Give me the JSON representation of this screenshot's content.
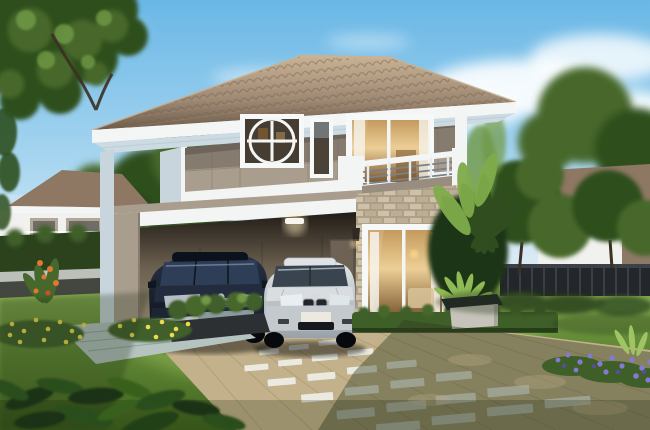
{
  "meta": {
    "title": "Two-story suburban house exterior 3D rendering",
    "time_of_day": "daytime",
    "visible_text": "none"
  },
  "scene": {
    "main_house": {
      "name": "two-story-house",
      "features": [
        "hip tiled roof",
        "two-tone taupe upper facade",
        "circle motif window",
        "slim window",
        "balcony with metal railing",
        "sliding glass balcony door",
        "stone veneer ground wall",
        "large sliding patio door with curtains",
        "two wall sconces",
        "double carport with ceiling light"
      ]
    },
    "vehicles": [
      {
        "name": "dark-sedan",
        "color": "dark navy"
      },
      {
        "name": "silver-sedan",
        "color": "silver"
      }
    ],
    "landscape": [
      "front lawn",
      "paved driveway with white inset pavers",
      "stone slab walkway",
      "planter box with shrubs",
      "yellow flower beds",
      "orange flowers",
      "purple flower border",
      "tropical plants and fan palm",
      "concrete garden bench",
      "low trimmed hedges",
      "overhanging tree canopy top-left",
      "foreground dark foliage"
    ],
    "surroundings": [
      "neighbor house left",
      "neighbor house right",
      "perimeter hedge wall with concrete cap",
      "dark metal fence",
      "background trees",
      "blue sky with clouds"
    ]
  },
  "colors": {
    "sky_top": "#69b7e6",
    "sky_mid": "#a9d6f0",
    "sky_low": "#e9f4fb",
    "cloud": "#ffffff",
    "haze": "#dfe9ee",
    "roof_hi": "#c9b294",
    "roof_md": "#9d8873",
    "roof_lo": "#6f5d4b",
    "fascia": "#f4f6f6",
    "soffit": "#ccdae2",
    "taupe_dk": "#867b6f",
    "taupe_lt": "#a99d8e",
    "band": "#f2f5f4",
    "side": "#c8d5dc",
    "frame": "#f7f9f9",
    "glass_dk": "#453c32",
    "warm_hi": "#eccf96",
    "warm_md": "#c49a5e",
    "warm_lo": "#7d5a32",
    "curtain": "#f6f2ea",
    "rail": "#798089",
    "panel": "#998d80",
    "stone": "#cdc1a9",
    "stone2": "#bcae95",
    "stoneln": "#a3947b",
    "cp_dark": "#211c16",
    "cp_mid": "#6e6252",
    "cp_wall": "#94876f",
    "cp_floor": "#c9b78d",
    "door_in": "#6e6254",
    "car1": "#161f2d",
    "car1w": "#31405a",
    "chrome": "#a9b1b8",
    "car2": "#c9cfd3",
    "car2dk": "#9aa2a9",
    "car2w": "#3a444f",
    "plate": "#ebe9e0",
    "lawn_hi": "#95b85c",
    "lawn_md": "#648c38",
    "lawn_lo": "#42641f",
    "hedge_dk": "#2b421c",
    "hedge_md": "#3f5f29",
    "cap": "#bcc0bb",
    "wallbase": "#44473f",
    "fence": "#23262b",
    "fence_hi": "#3c4148",
    "drv": "#c2b18a",
    "drv_ln": "#a08f68",
    "paver": "#edeee6",
    "walk": "#b5c4c0",
    "walk_ln": "#8fa19d",
    "step": "#8a9aa0",
    "box": "#2c3032",
    "tree_dk": "#2f4f1e",
    "tree_md": "#47682c",
    "tree_hi": "#6f9844",
    "trunk": "#3b3024",
    "banana": "#80ab4b",
    "fy": "#eeda4e",
    "fo": "#e2772f",
    "fp": "#837bd1",
    "fp2": "#564fa0",
    "nroof": "#8e7763",
    "nwall": "#f1f2ef",
    "nwin": "#6f6e66",
    "shadow": "#203012"
  }
}
